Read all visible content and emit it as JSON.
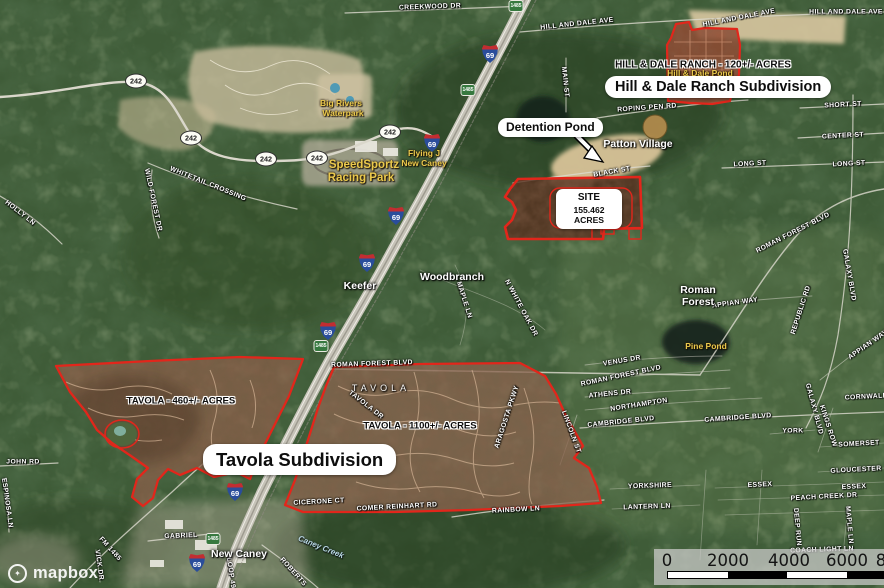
{
  "map": {
    "attribution": "mapbox",
    "colors": {
      "boundary_red": "#e2261b",
      "annotation_box_bg": "#ffffff",
      "annotation_text": "#0d0d0d",
      "poi_yellow": "#eac94d",
      "street_label": "#ffffff",
      "scale_panel": "rgba(203,203,201,0.74)"
    },
    "labels": {
      "streets": [
        {
          "t": "CREEKWOOD DR",
          "x": 430,
          "y": 7,
          "r": -2
        },
        {
          "t": "HILL AND DALE AVE",
          "x": 577,
          "y": 24,
          "r": -6
        },
        {
          "t": "HILL AND DALE AVE",
          "x": 739,
          "y": 18,
          "r": -11
        },
        {
          "t": "HILL AND DALE AVE",
          "x": 846,
          "y": 12,
          "r": 0
        },
        {
          "t": "MAIN ST",
          "x": 565,
          "y": 82,
          "r": 84
        },
        {
          "t": "SHORT ST",
          "x": 843,
          "y": 105,
          "r": -3
        },
        {
          "t": "CENTER ST",
          "x": 843,
          "y": 136,
          "r": -3
        },
        {
          "t": "LONG ST",
          "x": 750,
          "y": 164,
          "r": -3
        },
        {
          "t": "LONG ST",
          "x": 849,
          "y": 164,
          "r": -3
        },
        {
          "t": "ROPING PEN RD",
          "x": 647,
          "y": 108,
          "r": -4
        },
        {
          "t": "BLACK ST",
          "x": 612,
          "y": 172,
          "r": -10
        },
        {
          "t": "ROMAN FOREST BLVD",
          "x": 793,
          "y": 233,
          "r": -27
        },
        {
          "t": "WHITETAIL CROSSING",
          "x": 208,
          "y": 184,
          "r": 22
        },
        {
          "t": "WILD FOREST DR",
          "x": 153,
          "y": 200,
          "r": 78
        },
        {
          "t": "HOLLY LN",
          "x": 20,
          "y": 213,
          "r": 38
        },
        {
          "t": "JOHN RD",
          "x": 23,
          "y": 462,
          "r": 0
        },
        {
          "t": "ESPINOSA LN",
          "x": 7,
          "y": 503,
          "r": 82
        },
        {
          "t": "MAPLE LN",
          "x": 464,
          "y": 300,
          "r": 72
        },
        {
          "t": "N WHITE OAK DR",
          "x": 521,
          "y": 308,
          "r": 62
        },
        {
          "t": "ROMAN FOREST BLVD",
          "x": 372,
          "y": 364,
          "r": -2
        },
        {
          "t": "VENUS DR",
          "x": 622,
          "y": 361,
          "r": -10
        },
        {
          "t": "ROMAN FOREST BLVD",
          "x": 621,
          "y": 376,
          "r": -12
        },
        {
          "t": "ATHENS DR",
          "x": 610,
          "y": 394,
          "r": -6
        },
        {
          "t": "NORTHAMPTON",
          "x": 639,
          "y": 405,
          "r": -9
        },
        {
          "t": "CAMBRIDGE BLVD",
          "x": 621,
          "y": 422,
          "r": -6
        },
        {
          "t": "CAMBRIDGE BLVD",
          "x": 738,
          "y": 418,
          "r": -4
        },
        {
          "t": "YORK",
          "x": 793,
          "y": 431,
          "r": 0
        },
        {
          "t": "KINGS ROW",
          "x": 828,
          "y": 426,
          "r": 72
        },
        {
          "t": "GALAXY BLVD",
          "x": 849,
          "y": 275,
          "r": 80
        },
        {
          "t": "GALAXY BLVD",
          "x": 814,
          "y": 409,
          "r": 75
        },
        {
          "t": "SOMERSET",
          "x": 859,
          "y": 444,
          "r": -3
        },
        {
          "t": "GLOUCESTER",
          "x": 856,
          "y": 470,
          "r": -3
        },
        {
          "t": "ESSEX",
          "x": 760,
          "y": 485,
          "r": -3
        },
        {
          "t": "ESSEX",
          "x": 854,
          "y": 487,
          "r": -3
        },
        {
          "t": "PEACH CREEK DR",
          "x": 824,
          "y": 497,
          "r": -3
        },
        {
          "t": "YORKSHIRE",
          "x": 650,
          "y": 486,
          "r": -2
        },
        {
          "t": "LANTERN LN",
          "x": 647,
          "y": 507,
          "r": -2
        },
        {
          "t": "LINCOLN ST",
          "x": 571,
          "y": 432,
          "r": 70
        },
        {
          "t": "DEEP RUN",
          "x": 797,
          "y": 527,
          "r": 85
        },
        {
          "t": "MAPLE LN",
          "x": 849,
          "y": 525,
          "r": 85
        },
        {
          "t": "COACH LIGHT LN",
          "x": 822,
          "y": 550,
          "r": -2
        },
        {
          "t": "CORNWALL",
          "x": 866,
          "y": 397,
          "r": -3
        },
        {
          "t": "RAINBOW LN",
          "x": 516,
          "y": 510,
          "r": -3
        },
        {
          "t": "COMER REINHART RD",
          "x": 397,
          "y": 507,
          "r": -3
        },
        {
          "t": "CICERONE CT",
          "x": 319,
          "y": 502,
          "r": -3
        },
        {
          "t": "TAVOLA DR",
          "x": 366,
          "y": 405,
          "r": 38
        },
        {
          "t": "ARAGOSTA PKWY",
          "x": 507,
          "y": 417,
          "r": -72
        },
        {
          "t": "APPIAN WAY",
          "x": 735,
          "y": 303,
          "r": -8
        },
        {
          "t": "APPIAN WAY",
          "x": 868,
          "y": 345,
          "r": -35
        },
        {
          "t": "REPUBLIC RD",
          "x": 801,
          "y": 310,
          "r": -72
        },
        {
          "t": "GABRIEL",
          "x": 181,
          "y": 536,
          "r": -2
        },
        {
          "t": "FM 1485",
          "x": 110,
          "y": 549,
          "r": 48
        },
        {
          "t": "VICK DR",
          "x": 99,
          "y": 565,
          "r": 82
        },
        {
          "t": "ROBERTS",
          "x": 293,
          "y": 572,
          "r": 48
        },
        {
          "t": "LOOP 494",
          "x": 231,
          "y": 575,
          "r": 82
        }
      ],
      "places": [
        {
          "t": "Patton Village",
          "x": 638,
          "y": 144
        },
        {
          "t": "Woodbranch",
          "x": 452,
          "y": 277
        },
        {
          "t": "Keefer",
          "x": 360,
          "y": 286
        },
        {
          "t": "Roman",
          "x": 698,
          "y": 290
        },
        {
          "t": "Forest",
          "x": 698,
          "y": 302
        },
        {
          "t": "New Caney",
          "x": 239,
          "y": 554
        },
        {
          "t": "TAVOLA",
          "x": 381,
          "y": 388,
          "sp": true
        }
      ],
      "pois": [
        {
          "t": "Big Rivers",
          "x": 341,
          "y": 103
        },
        {
          "t": "Waterpark",
          "x": 343,
          "y": 113
        },
        {
          "t": "SpeedSportz",
          "x": 364,
          "y": 165,
          "big": true
        },
        {
          "t": "Racing Park",
          "x": 361,
          "y": 178,
          "big": true
        },
        {
          "t": "Flying J",
          "x": 424,
          "y": 153
        },
        {
          "t": "New Caney",
          "x": 424,
          "y": 163
        },
        {
          "t": "Hill & Dale Pond",
          "x": 700,
          "y": 73
        },
        {
          "t": "Pine Pond",
          "x": 706,
          "y": 346
        }
      ],
      "water": [
        {
          "t": "Caney Creek",
          "x": 321,
          "y": 547,
          "r": 22
        }
      ]
    },
    "shields": {
      "interstate": {
        "number": "69",
        "positions": [
          [
            490,
            54
          ],
          [
            432,
            143
          ],
          [
            396,
            216
          ],
          [
            367,
            263
          ],
          [
            328,
            331
          ],
          [
            235,
            492
          ],
          [
            197,
            563
          ]
        ]
      },
      "state242": {
        "number": "242",
        "positions": [
          [
            136,
            81
          ],
          [
            191,
            138
          ],
          [
            266,
            159
          ],
          [
            317,
            158
          ],
          [
            390,
            132
          ]
        ]
      },
      "fm": {
        "number": "1485",
        "positions": [
          [
            516,
            6
          ],
          [
            468,
            90
          ],
          [
            321,
            346
          ],
          [
            213,
            539
          ]
        ]
      }
    },
    "annotations": {
      "detention_box": {
        "text": "Detention Pond"
      },
      "site_box": {
        "line1": "SITE",
        "line2": "155.462 ACRES"
      },
      "hilldale_box": {
        "text": "Hill & Dale Ranch Subdivision"
      },
      "tavola_box": {
        "text": "Tavola Subdivision"
      },
      "hilldale_area_label": {
        "text": "HILL & DALE RANCH - 120+/- ACRES"
      },
      "tavola_west_label": {
        "text": "TAVOLA - 460+/- ACRES"
      },
      "tavola_east_label": {
        "text": "TAVOLA - 1100+/- ACRES"
      }
    },
    "scalebar": {
      "ticks": [
        {
          "t": "0",
          "x": 667
        },
        {
          "t": "2000",
          "x": 728
        },
        {
          "t": "4000",
          "x": 789
        },
        {
          "t": "6000",
          "x": 847
        },
        {
          "t": "8",
          "x": 881
        }
      ]
    },
    "logo_text": "mapbox"
  }
}
